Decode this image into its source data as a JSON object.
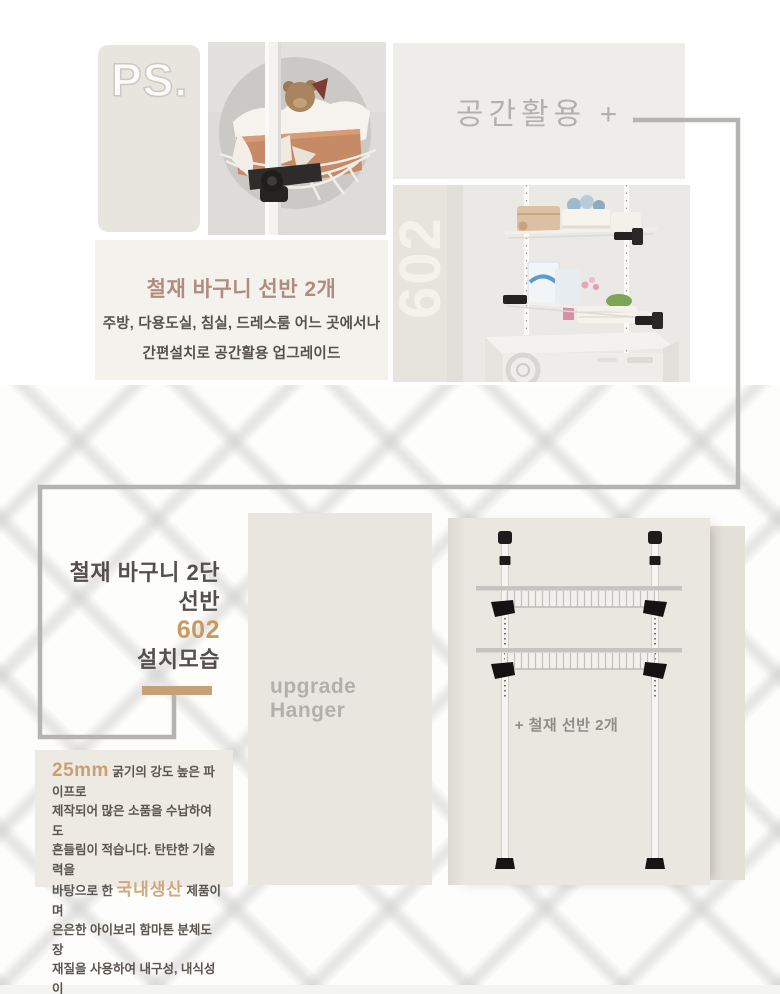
{
  "top": {
    "ps_label": "PS.",
    "space_label": "공간활용 +",
    "badge_602": "602",
    "feature": {
      "title": "철재 바구니 선반 2개",
      "line1": "주방, 다용도실, 침실, 드레스룸 어느 곳에서나",
      "line2": "간편설치로 공간활용 업그레이드"
    }
  },
  "install": {
    "headline": {
      "line1": "철재 바구니 2단",
      "line2": "선반",
      "number": "602",
      "line3": "설치모습"
    },
    "panel_label": "upgrade Hanger",
    "diagram_caption": "+ 철재 선반 2개"
  },
  "description": {
    "seg1": "25mm",
    "seg2": " 굵기의 강도 높은 파이프로\n제작되어 많은 소품을 수납하여도\n흔들림이 적습니다. 탄탄한 기술력을\n바탕으로 한 ",
    "seg3": "국내생산",
    "seg4": " 제품이며\n은은한 아이보리 함마톤 분체도장\n재질을 사용하여 내구성, 내식성이\n뛰어납니다."
  },
  "colors": {
    "accent_tan": "#c89a62",
    "bar_tan": "#c8a077",
    "highlight_tan": "#c9a074",
    "title_rose": "#b18a80",
    "text_dark": "#56514b",
    "muted_gray": "#b3b1ad",
    "line_gray": "#b6b4b1",
    "panel_beige": "#e9e6e0",
    "box_beige": "#e8e5df"
  }
}
